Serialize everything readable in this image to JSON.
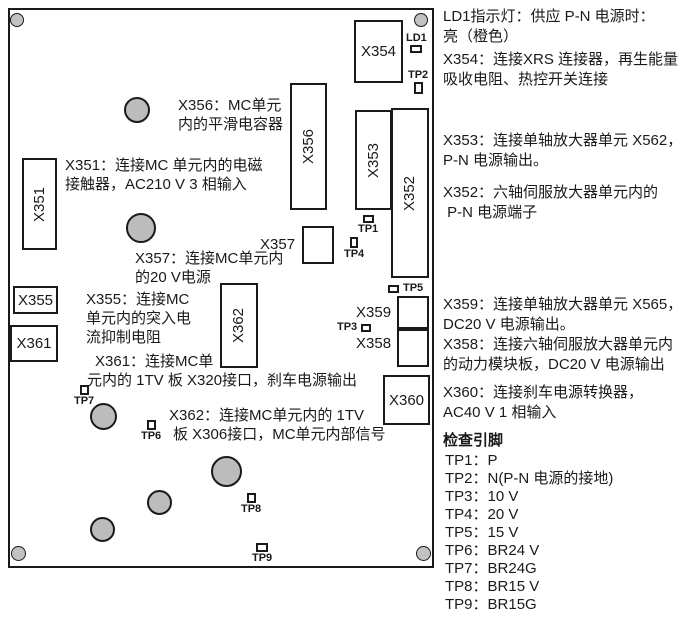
{
  "colors": {
    "ink": "#1a1a1a",
    "component_fill": "#bcbcbc",
    "background": "#ffffff"
  },
  "board": {
    "connectors": {
      "x351": "X351",
      "x352": "X352",
      "x353": "X353",
      "x354": "X354",
      "x355": "X355",
      "x356": "X356",
      "x360": "X360",
      "x361": "X361",
      "x362": "X362"
    },
    "outside_labels": {
      "x357": "X357",
      "x358": "X358",
      "x359": "X359"
    },
    "testpoints": {
      "ld1": "LD1",
      "tp1": "TP1",
      "tp2": "TP2",
      "tp3": "TP3",
      "tp4": "TP4",
      "tp5": "TP5",
      "tp6": "TP6",
      "tp7": "TP7",
      "tp8": "TP8",
      "tp9": "TP9"
    },
    "notes": {
      "x356": {
        "l1": "X356：MC单元",
        "l2": "内的平滑电容器"
      },
      "x351": {
        "l1": "X351：连接MC 单元内的电磁",
        "l2": "接触器，AC210 V 3 相输入"
      },
      "x357": {
        "l1": "X357：连接MC单元内",
        "l2": "的20 V电源"
      },
      "x355": {
        "l1": "X355：连接MC",
        "l2": "单元内的突入电",
        "l3": "流抑制电阻"
      },
      "x361": {
        "l1": "X361：连接MC单",
        "l2": "元内的 1TV 板 X320接口，刹车电源输出"
      },
      "x362": {
        "l1": "X362：连接MC单元内的 1TV",
        "l2": "板 X306接口，MC单元内部信号"
      }
    }
  },
  "legend": {
    "notes": {
      "ld1": {
        "l1": "LD1指示灯：供应 P-N 电源时：",
        "l2": "亮（橙色）"
      },
      "x354": {
        "l1": "X354：连接XRS 连接器，再生能量",
        "l2": "吸收电阻、热控开关连接"
      },
      "x353": {
        "l1": "X353：连接单轴放大器单元 X562，",
        "l2": "P-N 电源输出。"
      },
      "x352": {
        "l1": "X352：六轴伺服放大器单元内的",
        "l2": " P-N 电源端子"
      },
      "x359": {
        "l1": "X359：连接单轴放大器单元 X565，",
        "l2": "DC20 V 电源输出。"
      },
      "x358": {
        "l1": "X358：连接六轴伺服放大器单元内",
        "l2": "的动力模块板，DC20 V 电源输出"
      },
      "x360": {
        "l1": "X360：连接刹车电源转换器，",
        "l2": "AC40 V 1 相输入"
      }
    },
    "checkpins_header": "检查引脚",
    "checkpins": [
      "TP1：P",
      "TP2：N(P-N 电源的接地)",
      "TP3：10 V",
      "TP4：20 V",
      "TP5：15 V",
      "TP6：BR24 V",
      "TP7：BR24G",
      "TP8：BR15 V",
      "TP9：BR15G"
    ]
  }
}
